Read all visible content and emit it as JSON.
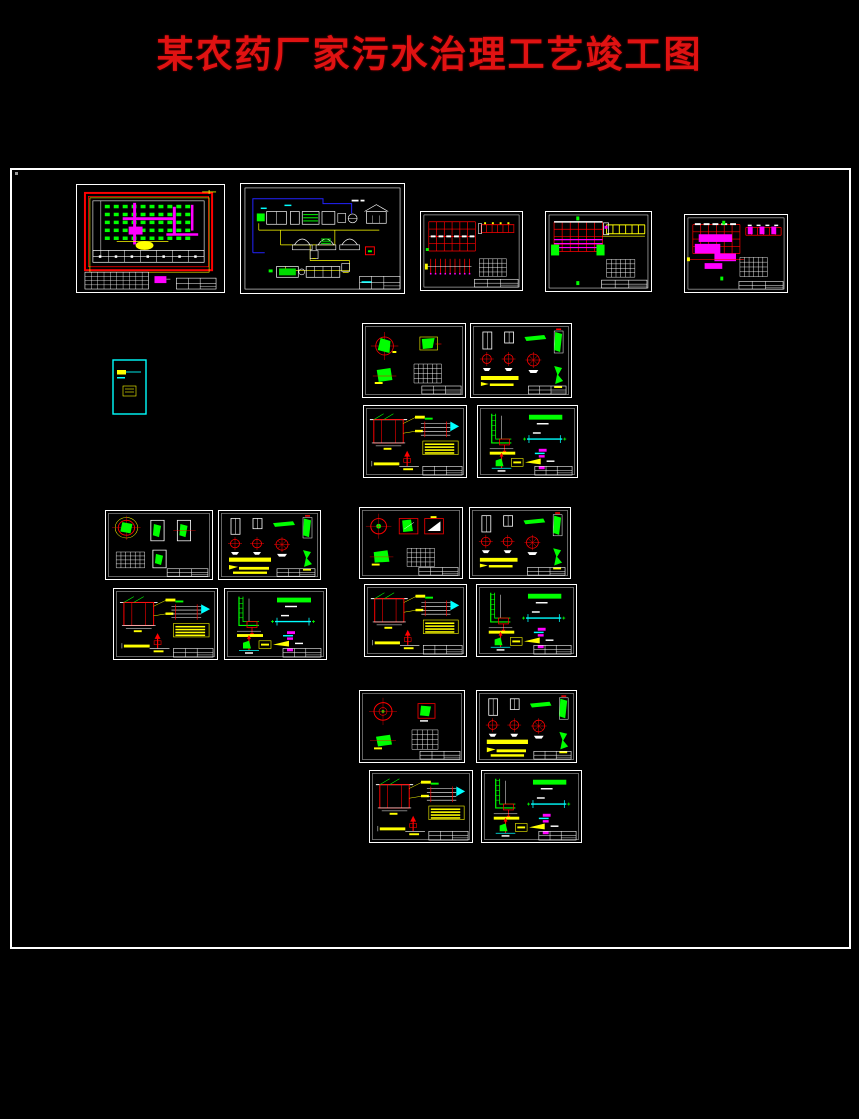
{
  "page": {
    "title": "某农药厂家污水治理工艺竣工图",
    "title_color": "#e01212",
    "background": "#000000"
  },
  "canvas": {
    "x": 10,
    "y": 168,
    "w": 841,
    "h": 781,
    "border_color": "#ffffff"
  },
  "palette": {
    "red": "#ff0000",
    "green": "#00ff00",
    "yellow": "#ffff00",
    "magenta": "#ff00ff",
    "cyan": "#00ffff",
    "blue": "#2222ff",
    "white": "#ffffff",
    "tank_green": "#00dd00"
  },
  "sheets": [
    {
      "id": "01",
      "label": "plant-plan",
      "kind": "plan",
      "variant": 1,
      "x": 76,
      "y": 184,
      "w": 149,
      "h": 109
    },
    {
      "id": "02",
      "label": "process-flow",
      "kind": "flow",
      "variant": 1,
      "x": 240,
      "y": 183,
      "w": 165,
      "h": 111
    },
    {
      "id": "03",
      "label": "rebar-layout-1",
      "kind": "rebar",
      "variant": 1,
      "x": 420,
      "y": 211,
      "w": 103,
      "h": 80
    },
    {
      "id": "04",
      "label": "rebar-layout-2",
      "kind": "rebar",
      "variant": 2,
      "x": 545,
      "y": 211,
      "w": 107,
      "h": 81
    },
    {
      "id": "05",
      "label": "rebar-layout-3",
      "kind": "rebar",
      "variant": 3,
      "x": 684,
      "y": 214,
      "w": 104,
      "h": 79
    },
    {
      "id": "06",
      "label": "note-sheet",
      "kind": "mini",
      "variant": 1,
      "x": 110,
      "y": 358,
      "w": 39,
      "h": 59
    },
    {
      "id": "07",
      "label": "detail-circles-1",
      "kind": "detailA",
      "variant": 1,
      "x": 362,
      "y": 323,
      "w": 104,
      "h": 75
    },
    {
      "id": "08",
      "label": "detail-bars-1",
      "kind": "detailB",
      "variant": 1,
      "x": 470,
      "y": 323,
      "w": 102,
      "h": 75
    },
    {
      "id": "09",
      "label": "detail-frame-1",
      "kind": "detailC",
      "variant": 1,
      "x": 363,
      "y": 405,
      "w": 104,
      "h": 73
    },
    {
      "id": "10",
      "label": "detail-channel-1",
      "kind": "detailD",
      "variant": 1,
      "x": 477,
      "y": 405,
      "w": 101,
      "h": 73
    },
    {
      "id": "11",
      "label": "detail-circles-2",
      "kind": "detailA",
      "variant": 2,
      "x": 105,
      "y": 510,
      "w": 108,
      "h": 70
    },
    {
      "id": "12",
      "label": "detail-bars-2",
      "kind": "detailB",
      "variant": 2,
      "x": 218,
      "y": 510,
      "w": 103,
      "h": 70
    },
    {
      "id": "13",
      "label": "detail-circles-3",
      "kind": "detailA",
      "variant": 3,
      "x": 359,
      "y": 507,
      "w": 104,
      "h": 72
    },
    {
      "id": "14",
      "label": "detail-bars-3",
      "kind": "detailB",
      "variant": 3,
      "x": 469,
      "y": 507,
      "w": 102,
      "h": 72
    },
    {
      "id": "15",
      "label": "detail-frame-2",
      "kind": "detailC",
      "variant": 2,
      "x": 113,
      "y": 588,
      "w": 105,
      "h": 72
    },
    {
      "id": "16",
      "label": "detail-channel-2",
      "kind": "detailD",
      "variant": 2,
      "x": 224,
      "y": 588,
      "w": 103,
      "h": 72
    },
    {
      "id": "17",
      "label": "detail-frame-3",
      "kind": "detailC",
      "variant": 3,
      "x": 364,
      "y": 584,
      "w": 103,
      "h": 73
    },
    {
      "id": "18",
      "label": "detail-channel-3",
      "kind": "detailD",
      "variant": 3,
      "x": 476,
      "y": 584,
      "w": 101,
      "h": 73
    },
    {
      "id": "19",
      "label": "detail-circles-4",
      "kind": "detailA",
      "variant": 4,
      "x": 359,
      "y": 690,
      "w": 106,
      "h": 73
    },
    {
      "id": "20",
      "label": "detail-bars-4",
      "kind": "detailB",
      "variant": 4,
      "x": 476,
      "y": 690,
      "w": 101,
      "h": 73
    },
    {
      "id": "21",
      "label": "detail-frame-4",
      "kind": "detailC",
      "variant": 4,
      "x": 369,
      "y": 770,
      "w": 104,
      "h": 73
    },
    {
      "id": "22",
      "label": "detail-channel-4",
      "kind": "detailD",
      "variant": 4,
      "x": 481,
      "y": 770,
      "w": 101,
      "h": 73
    }
  ]
}
